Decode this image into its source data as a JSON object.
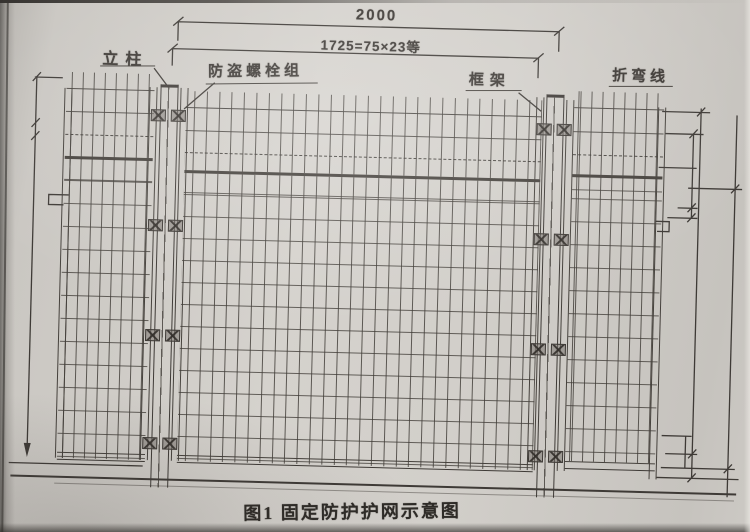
{
  "figure": {
    "caption": "图1 固定防护护网示意图"
  },
  "dimensions": {
    "top_width": "2000",
    "mesh_pitch": "1725=75×23等"
  },
  "callouts": {
    "post": "立柱",
    "anti_theft_bolt_group": "防盗螺栓组",
    "frame": "框架",
    "bend_line": "折弯线"
  },
  "colors": {
    "paper": "#d2cfca",
    "ink": "#3e3a36"
  }
}
